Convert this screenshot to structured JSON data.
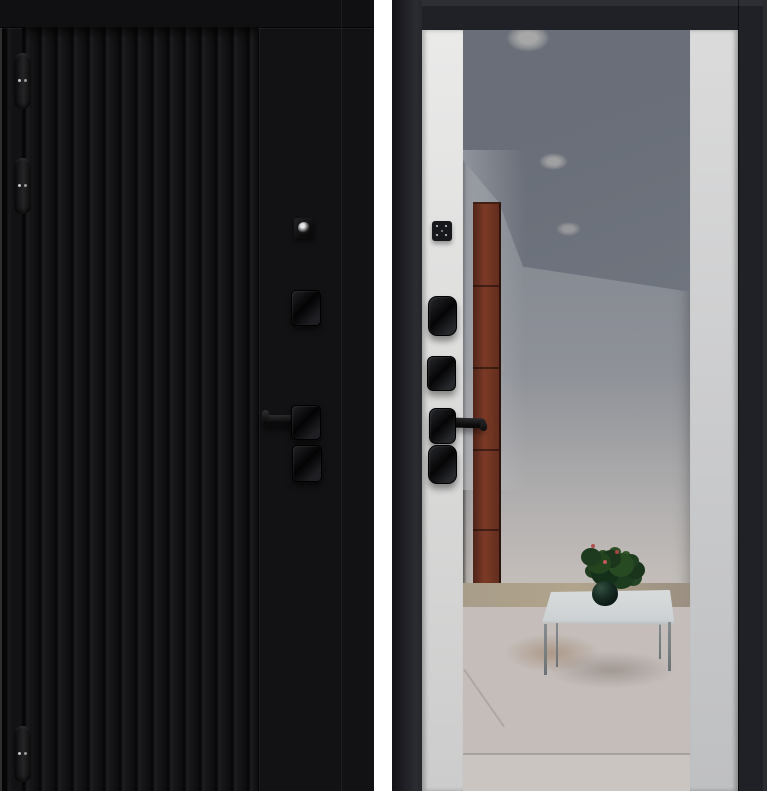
{
  "meta": {
    "subject": "Entry door product photo, exterior and interior views side by side",
    "views_count": "2"
  },
  "palette": {
    "page_background": "#ffffff",
    "exterior_black": "#121214",
    "interior_frame_charcoal": "#202126",
    "interior_panel_white": "#dededd",
    "mirror_ceiling_gray": "#6f747d",
    "mirror_wall_gray": "#b6b5b7",
    "cabinet_red_brown": "#7b3a26",
    "floor_beige": "#aa9f8a",
    "floor_tile": "#c4bdba",
    "hardware_black": "#0b0b0c",
    "plant_green": "#24431f"
  },
  "exterior_view": {
    "name": "black-fluted-door-exterior",
    "finish": "Matte black door leaf with vertical fluted panel and flat lock stile",
    "hinges": [
      {
        "label": "top hinge"
      },
      {
        "label": "middle hinge"
      },
      {
        "label": "bottom hinge"
      }
    ],
    "hardware": [
      {
        "label": "peephole / cylinder plate"
      },
      {
        "label": "upper lock escutcheon"
      },
      {
        "label": "lever handle pointing left"
      },
      {
        "label": "lower lock escutcheon"
      }
    ]
  },
  "interior_view": {
    "name": "white-mirror-door-interior",
    "finish": "Charcoal frame, white side panels, full-height central mirror",
    "hardware": [
      {
        "label": "thumb-turn square plate"
      },
      {
        "label": "upper lock escutcheon"
      },
      {
        "label": "secondary lock escutcheon"
      },
      {
        "label": "lever handle pointing right"
      },
      {
        "label": "lower lock escutcheon"
      }
    ],
    "mirror_reflection": {
      "ceiling": "gray ceiling with three recessed round lights",
      "left_side": "red-brown cabinet panels with seams",
      "wall": "light gray wall",
      "floor": "beige band and light tiled floor",
      "furniture": "glass-top coffee table with dark potted plant and small red flowers"
    }
  }
}
